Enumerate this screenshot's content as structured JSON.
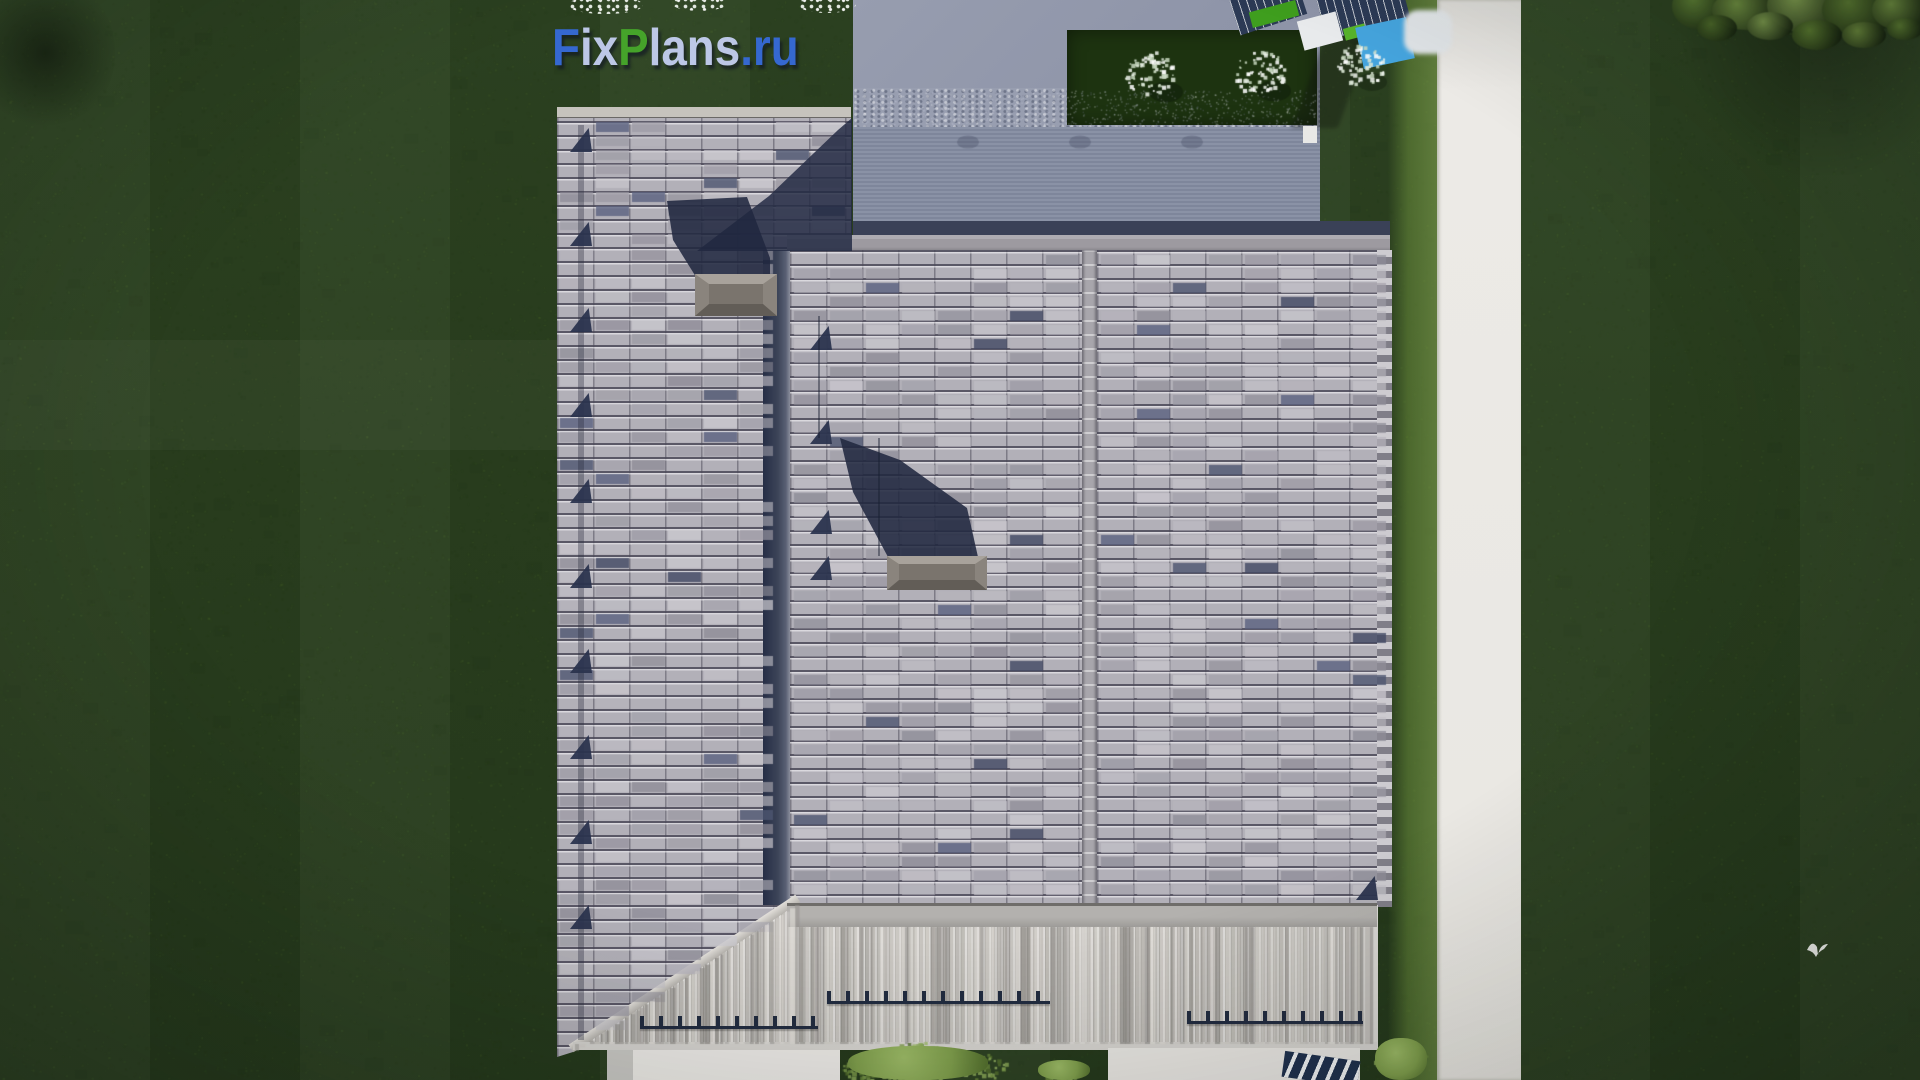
{
  "watermark": {
    "text": "FixPlans.ru",
    "segments": [
      {
        "text": "F",
        "color": "#3568d0"
      },
      {
        "text": "ix",
        "color": "#bcc7e6"
      },
      {
        "text": "P",
        "color": "#45a32a"
      },
      {
        "text": "lans",
        "color": "#bcc7e6"
      },
      {
        "text": ".ru",
        "color": "#3568d0"
      }
    ]
  },
  "scene": {
    "description": "Aerial top-down 3D render of a gray tiled house roof on a dark green lawn",
    "chimney_count": "2",
    "white_flower_bush_count": "3",
    "features": "valley gutter, snow guards, rooftop snow rails, white walkway, flying bird, overhanging tree canopy"
  },
  "palette": {
    "grass_base": "#2b401f",
    "grass_light": "#577235",
    "grass_sunlit": "#64823a",
    "path": "#e9e7e2",
    "flat_roof": "#8f95a9",
    "flat_edge_navy": "#3a4157",
    "tile_base": "#b2b0b8",
    "tile_light": "#cbc9cf",
    "tile_mid": "#a3a1ab",
    "tile_dark": "#8e8c97",
    "tile_navy": "#4e5671",
    "valley_dark": "#2a3248",
    "shadow_navy": "rgba(33,40,64,0.88)",
    "cap_light": "#a8a29b",
    "cap_mid": "#8a847d",
    "cap_dark": "#625d57",
    "cap_core": "#7a746d",
    "fascia": "#b0aeab",
    "terrace_light": "#dedbd6",
    "terrace_mid": "#bdbab5",
    "terrace_dark": "#8a8783",
    "bed_green": "#1d3310",
    "bush_white": "#eef3ec",
    "bush_green": "#7f9e4c",
    "rail_navy": "#222c40",
    "logo_blue": "#3568d0",
    "logo_light": "#bcc7e6",
    "logo_green": "#45a32a",
    "obj_navy": "#2c3a55",
    "obj_green": "#3f9e1e",
    "obj_sky": "#45a4dd",
    "hip_cap": "#cac7c2"
  }
}
